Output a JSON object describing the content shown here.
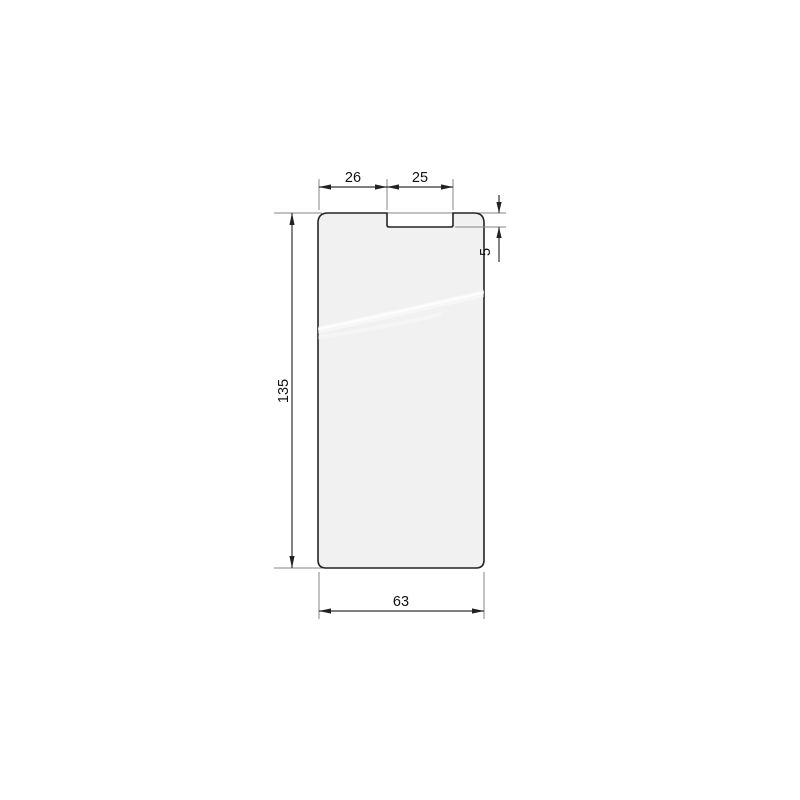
{
  "diagram": {
    "type": "technical-drawing",
    "part_name": "screen-protector-outline",
    "labels": {
      "top_left_segment_width": "26",
      "notch_width": "25",
      "notch_depth": "5",
      "overall_height": "135",
      "overall_width": "63"
    },
    "colors": {
      "background": "#ffffff",
      "shape_fill": "#f1f1f1",
      "shape_outline": "#242424",
      "dimension_line": "#333333",
      "extension_line": "#858585",
      "arrow_fill": "#222222",
      "text": "#111111",
      "sheen": "#ffffff"
    }
  }
}
